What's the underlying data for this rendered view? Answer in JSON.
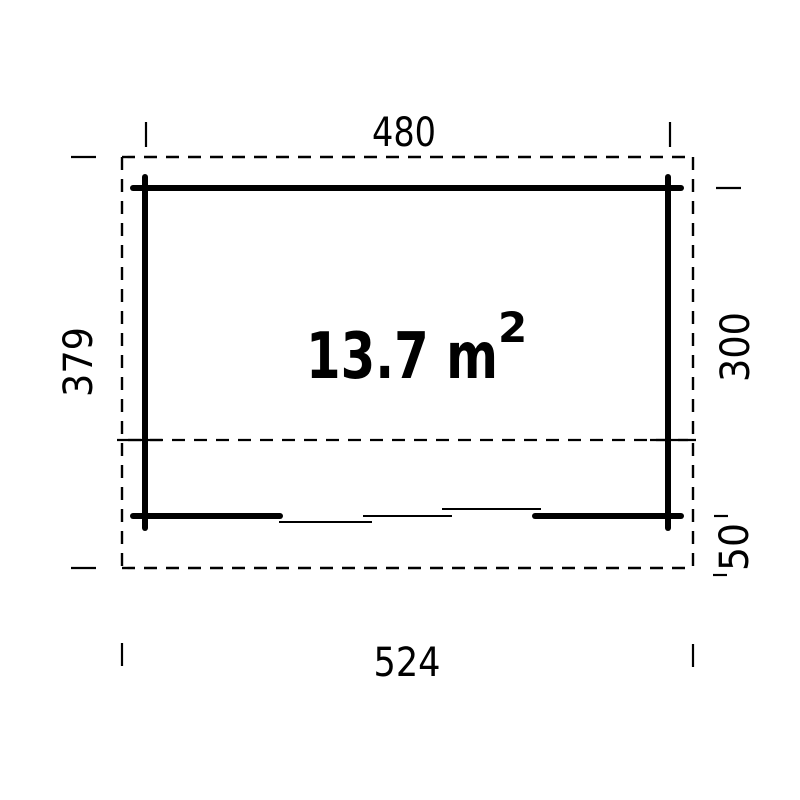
{
  "colors": {
    "ink": "#000000",
    "background": "#ffffff"
  },
  "floor_plan": {
    "area_label": {
      "text": "13.7 m",
      "superscript": "2"
    },
    "dimensions": {
      "wall_width_top": "480",
      "overall_width_bottom": "524",
      "overall_depth_left": "379",
      "wall_depth_right": "300",
      "roof_overhang_right": "50"
    }
  }
}
